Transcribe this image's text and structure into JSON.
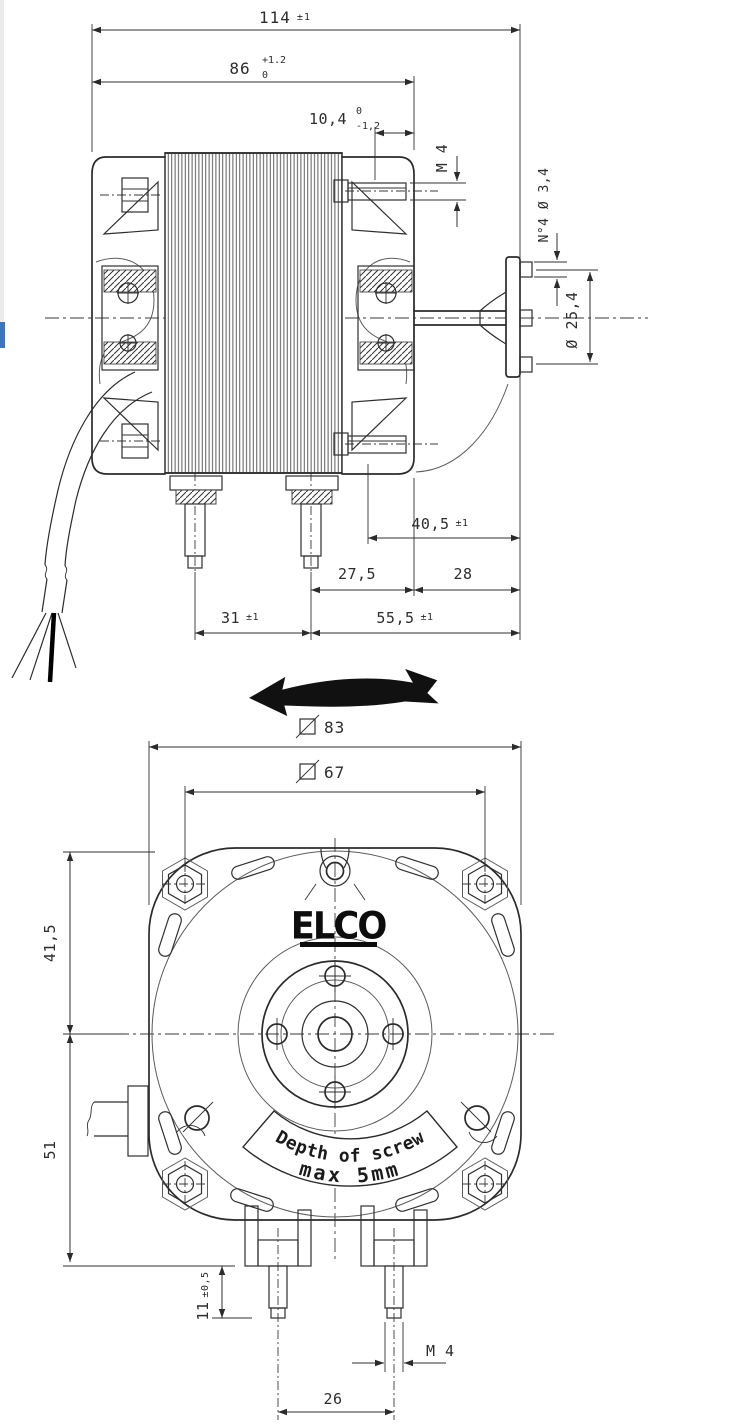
{
  "colors": {
    "background": "#ffffff",
    "line": "#2b2b2b",
    "dim_text": "#2d2d2d",
    "logo": "#0d0d0d",
    "edge_strip_gray": "#ececec",
    "edge_strip_blue": "#3b74c4",
    "direction_arrow_fill": "#111111"
  },
  "side_view": {
    "dims": {
      "overall_length": {
        "value": "114",
        "tol": "±1"
      },
      "body_length": {
        "value": "86",
        "tol_upper": "+1.2",
        "tol_lower": "0"
      },
      "hub_depth": {
        "value": "10,4",
        "tol_upper": "0",
        "tol_lower": "-1,2"
      },
      "top_stud_thread": "M 4",
      "flange_holes": "N°4 Ø 3,4",
      "bolt_circle_dia": "Ø 25,4",
      "shaft_to_face": {
        "value": "40,5",
        "tol": "±1"
      },
      "stud_to_face": "27,5",
      "face_to_shaft_end": "28",
      "stud_spacing": {
        "value": "31",
        "tol": "±1"
      },
      "stud_to_shaft_end": {
        "value": "55,5",
        "tol": "±1"
      }
    }
  },
  "front_view": {
    "logo_text": "ELCO",
    "banner": {
      "line1": "Depth of screw",
      "line2": "max 5mm"
    },
    "dims": {
      "outer_square": "83",
      "mount_square": "67",
      "center_to_top": "41,5",
      "center_to_bottom": "51",
      "stud_length": {
        "value": "11",
        "tol": "±0,5"
      },
      "stud_thread": "M 4",
      "stud_spacing": "26"
    }
  },
  "icons": {
    "square_symbol": "square-slash-icon",
    "direction_arrow": "curved-double-arrow-icon"
  }
}
